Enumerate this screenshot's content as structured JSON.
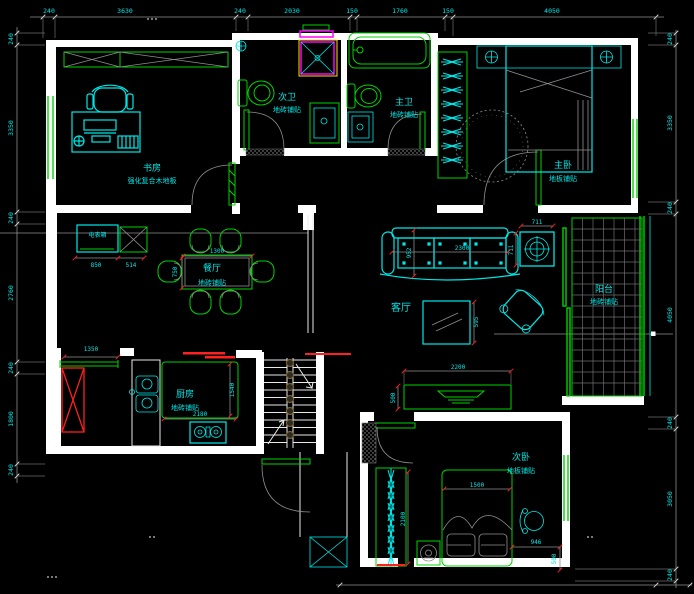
{
  "drawing": {
    "background": "#000000",
    "palette": {
      "line_cyan": "#00e8e8",
      "line_green": "#00d400",
      "line_grey": "#8f8f8f",
      "wall_white": "#ffffff",
      "shower_magenta": "#ff00ff",
      "shower_yellow": "#ffe000",
      "flue_red": "#ff2020"
    },
    "rooms": {
      "study": {
        "name": "书房",
        "finish": "强化复合木地板"
      },
      "second_bath": {
        "name": "次卫",
        "finish": "地砖铺贴"
      },
      "master_bath": {
        "name": "主卫",
        "finish": "地砖铺贴"
      },
      "master_bedroom": {
        "name": "主卧",
        "finish": "地板铺贴"
      },
      "dining": {
        "name": "餐厅",
        "finish": "地砖铺贴"
      },
      "living": {
        "name": "客厅"
      },
      "balcony": {
        "name": "阳台",
        "finish": "地砖铺贴"
      },
      "kitchen": {
        "name": "厨房",
        "finish": "地砖铺贴"
      },
      "second_bedroom": {
        "name": "次卧",
        "finish": "地板铺贴"
      }
    },
    "meter_box": "电表箱",
    "dims_top": [
      "240",
      "3630",
      "240",
      "2030",
      "150",
      "1760",
      "150",
      "4050"
    ],
    "dims_left": [
      "240",
      "3350",
      "240",
      "2760",
      "240",
      "1800",
      "240"
    ],
    "dims_right": [
      "240",
      "3350",
      "240",
      "4050",
      "240",
      "3050",
      "240"
    ],
    "dims_inner": {
      "sofa_w": "2300",
      "sofa_d": "952",
      "table_w": "711",
      "table_d": "711",
      "mirror": "595",
      "tv_w": "2200",
      "tv_d": "500",
      "dining_w": "1300",
      "dining_d": "750",
      "meter_w": "850",
      "meter_off": "514",
      "kitchen_front": "1350",
      "kitchen_w": "2180",
      "kitchen_d": "1540",
      "bed_w": "1500",
      "bed_l": "2100",
      "stand_w": "946",
      "stand_d": "500"
    }
  }
}
